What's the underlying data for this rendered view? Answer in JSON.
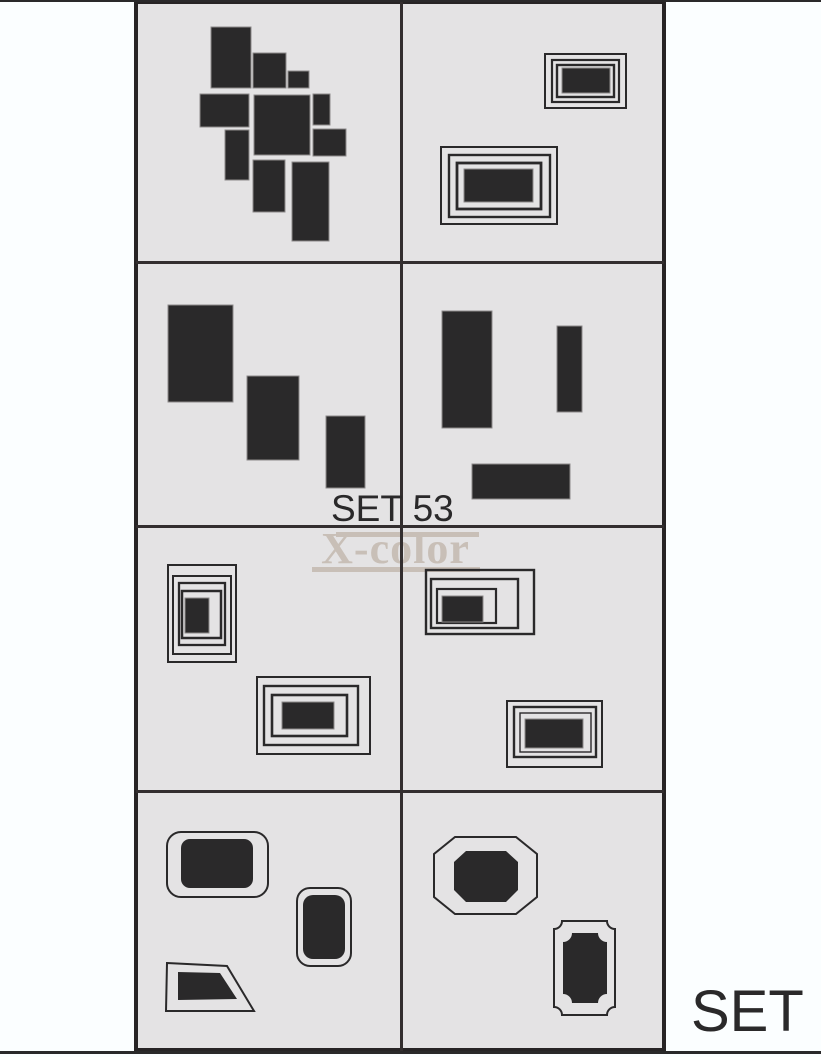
{
  "colors": {
    "background": "#fbfeff",
    "panel": "#e4e3e4",
    "ink": "#2a292a",
    "grid_line": "#332e2f",
    "border": "#272425",
    "shape_edge": "#8d8a8a",
    "watermark": "#c8bfb7"
  },
  "labels": {
    "set_center": "SET 53",
    "watermark": "X-color",
    "set_corner": "SET"
  },
  "grid": {
    "x": 134,
    "y": 0,
    "w": 532,
    "h": 1052,
    "rows": 4,
    "cols": 2
  },
  "shapes": [
    {
      "cell": "r1c1",
      "kind": "rect",
      "name": "decal-rect-1",
      "r": [
        211,
        27,
        40,
        61
      ]
    },
    {
      "cell": "r1c1",
      "kind": "rect",
      "name": "decal-rect-2",
      "r": [
        253,
        53,
        33,
        35
      ]
    },
    {
      "cell": "r1c1",
      "kind": "rect",
      "name": "decal-rect-3",
      "r": [
        288,
        71,
        21,
        17
      ]
    },
    {
      "cell": "r1c1",
      "kind": "rect",
      "name": "decal-rect-4",
      "r": [
        200,
        94,
        49,
        33
      ]
    },
    {
      "cell": "r1c1",
      "kind": "rect",
      "name": "decal-rect-5",
      "r": [
        254,
        95,
        56,
        60
      ]
    },
    {
      "cell": "r1c1",
      "kind": "rect",
      "name": "decal-rect-6",
      "r": [
        313,
        94,
        17,
        31
      ]
    },
    {
      "cell": "r1c1",
      "kind": "rect",
      "name": "decal-rect-7",
      "r": [
        313,
        129,
        33,
        27
      ]
    },
    {
      "cell": "r1c1",
      "kind": "rect",
      "name": "decal-rect-8",
      "r": [
        225,
        130,
        24,
        50
      ]
    },
    {
      "cell": "r1c1",
      "kind": "rect",
      "name": "decal-rect-9",
      "r": [
        253,
        160,
        32,
        52
      ]
    },
    {
      "cell": "r1c1",
      "kind": "rect",
      "name": "decal-rect-10",
      "r": [
        292,
        162,
        37,
        79
      ]
    },
    {
      "cell": "r1c2",
      "kind": "frame",
      "name": "nested-frame-small",
      "rings": [
        [
          545,
          54,
          81,
          54,
          2
        ],
        [
          552,
          60,
          67,
          42,
          2.2
        ],
        [
          557,
          65,
          57,
          32,
          2.4
        ]
      ],
      "fill": [
        562,
        68,
        48,
        25
      ]
    },
    {
      "cell": "r1c2",
      "kind": "frame",
      "name": "nested-frame-large",
      "rings": [
        [
          441,
          147,
          116,
          77,
          2
        ],
        [
          449,
          155,
          101,
          62,
          2.4
        ],
        [
          457,
          163,
          84,
          46,
          2.8
        ]
      ],
      "fill": [
        464,
        169,
        69,
        33
      ]
    },
    {
      "cell": "r2c1",
      "kind": "rect",
      "name": "decal-rect-11",
      "r": [
        168,
        305,
        65,
        97
      ]
    },
    {
      "cell": "r2c1",
      "kind": "rect",
      "name": "decal-rect-12",
      "r": [
        247,
        376,
        52,
        84
      ]
    },
    {
      "cell": "r2c1",
      "kind": "rect",
      "name": "decal-rect-13",
      "r": [
        326,
        416,
        39,
        72
      ]
    },
    {
      "cell": "r2c2",
      "kind": "rect",
      "name": "decal-rect-14",
      "r": [
        442,
        311,
        50,
        117
      ]
    },
    {
      "cell": "r2c2",
      "kind": "rect",
      "name": "decal-rect-15",
      "r": [
        557,
        326,
        25,
        86
      ]
    },
    {
      "cell": "r2c2",
      "kind": "rect",
      "name": "decal-rect-16",
      "r": [
        472,
        464,
        98,
        35
      ]
    },
    {
      "cell": "r3c1",
      "kind": "frame",
      "name": "nested-frame-vertical",
      "rings": [
        [
          168,
          565,
          68,
          97,
          2
        ],
        [
          173,
          576,
          58,
          78,
          2
        ],
        [
          179,
          583,
          46,
          62,
          2.3
        ],
        [
          182,
          591,
          39,
          47,
          2.5
        ]
      ],
      "fill": [
        185,
        598,
        24,
        35
      ]
    },
    {
      "cell": "r3c1",
      "kind": "frame",
      "name": "nested-frame-horizontal",
      "rings": [
        [
          257,
          677,
          113,
          77,
          2
        ],
        [
          264,
          686,
          94,
          59,
          2.4
        ],
        [
          272,
          695,
          75,
          41,
          2.6
        ]
      ],
      "fill": [
        282,
        702,
        52,
        27
      ]
    },
    {
      "cell": "r3c2",
      "kind": "frame",
      "name": "nested-frame-offset",
      "rings": [
        [
          426,
          570,
          108,
          64,
          2.4
        ],
        [
          431,
          579,
          87,
          49,
          2.4
        ],
        [
          437,
          589,
          59,
          34,
          2.2
        ]
      ],
      "fill": [
        442,
        596,
        41,
        26
      ]
    },
    {
      "cell": "r3c2",
      "kind": "frame",
      "name": "nested-frame-bottom-right",
      "rings": [
        [
          507,
          701,
          95,
          66,
          2
        ],
        [
          514,
          707,
          82,
          50,
          2.4
        ],
        [
          520,
          713,
          71,
          39,
          1.4
        ]
      ],
      "fill": [
        525,
        719,
        58,
        29
      ]
    },
    {
      "cell": "r4c1",
      "kind": "rrect",
      "name": "rounded-frame-large",
      "outer": [
        167,
        832,
        101,
        65,
        14,
        2
      ],
      "fill": [
        181,
        839,
        72,
        49,
        9
      ]
    },
    {
      "cell": "r4c1",
      "kind": "rrect",
      "name": "rounded-frame-small",
      "outer": [
        297,
        888,
        54,
        78,
        13,
        2
      ],
      "fill": [
        303,
        895,
        42,
        64,
        10
      ]
    },
    {
      "cell": "r4c1",
      "kind": "poly",
      "name": "trapezoid",
      "sw": 2,
      "outer": [
        [
          167,
          963
        ],
        [
          227,
          966
        ],
        [
          254,
          1011
        ],
        [
          166,
          1011
        ]
      ],
      "fill": [
        [
          178,
          972
        ],
        [
          220,
          973
        ],
        [
          237,
          999
        ],
        [
          178,
          1000
        ]
      ]
    },
    {
      "cell": "r4c2",
      "kind": "poly",
      "name": "octagon",
      "sw": 2,
      "outer": [
        [
          455,
          837
        ],
        [
          516,
          837
        ],
        [
          537,
          854
        ],
        [
          537,
          897
        ],
        [
          516,
          914
        ],
        [
          455,
          914
        ],
        [
          434,
          897
        ],
        [
          434,
          854
        ]
      ],
      "fill": [
        [
          466,
          851
        ],
        [
          506,
          851
        ],
        [
          518,
          862
        ],
        [
          518,
          890
        ],
        [
          506,
          902
        ],
        [
          466,
          902
        ],
        [
          454,
          890
        ],
        [
          454,
          862
        ]
      ]
    },
    {
      "cell": "r4c2",
      "kind": "notched",
      "name": "ticket-frame",
      "outer": [
        554,
        921,
        61,
        94,
        8,
        2
      ],
      "fill": [
        563,
        933,
        44,
        70,
        9
      ]
    }
  ]
}
